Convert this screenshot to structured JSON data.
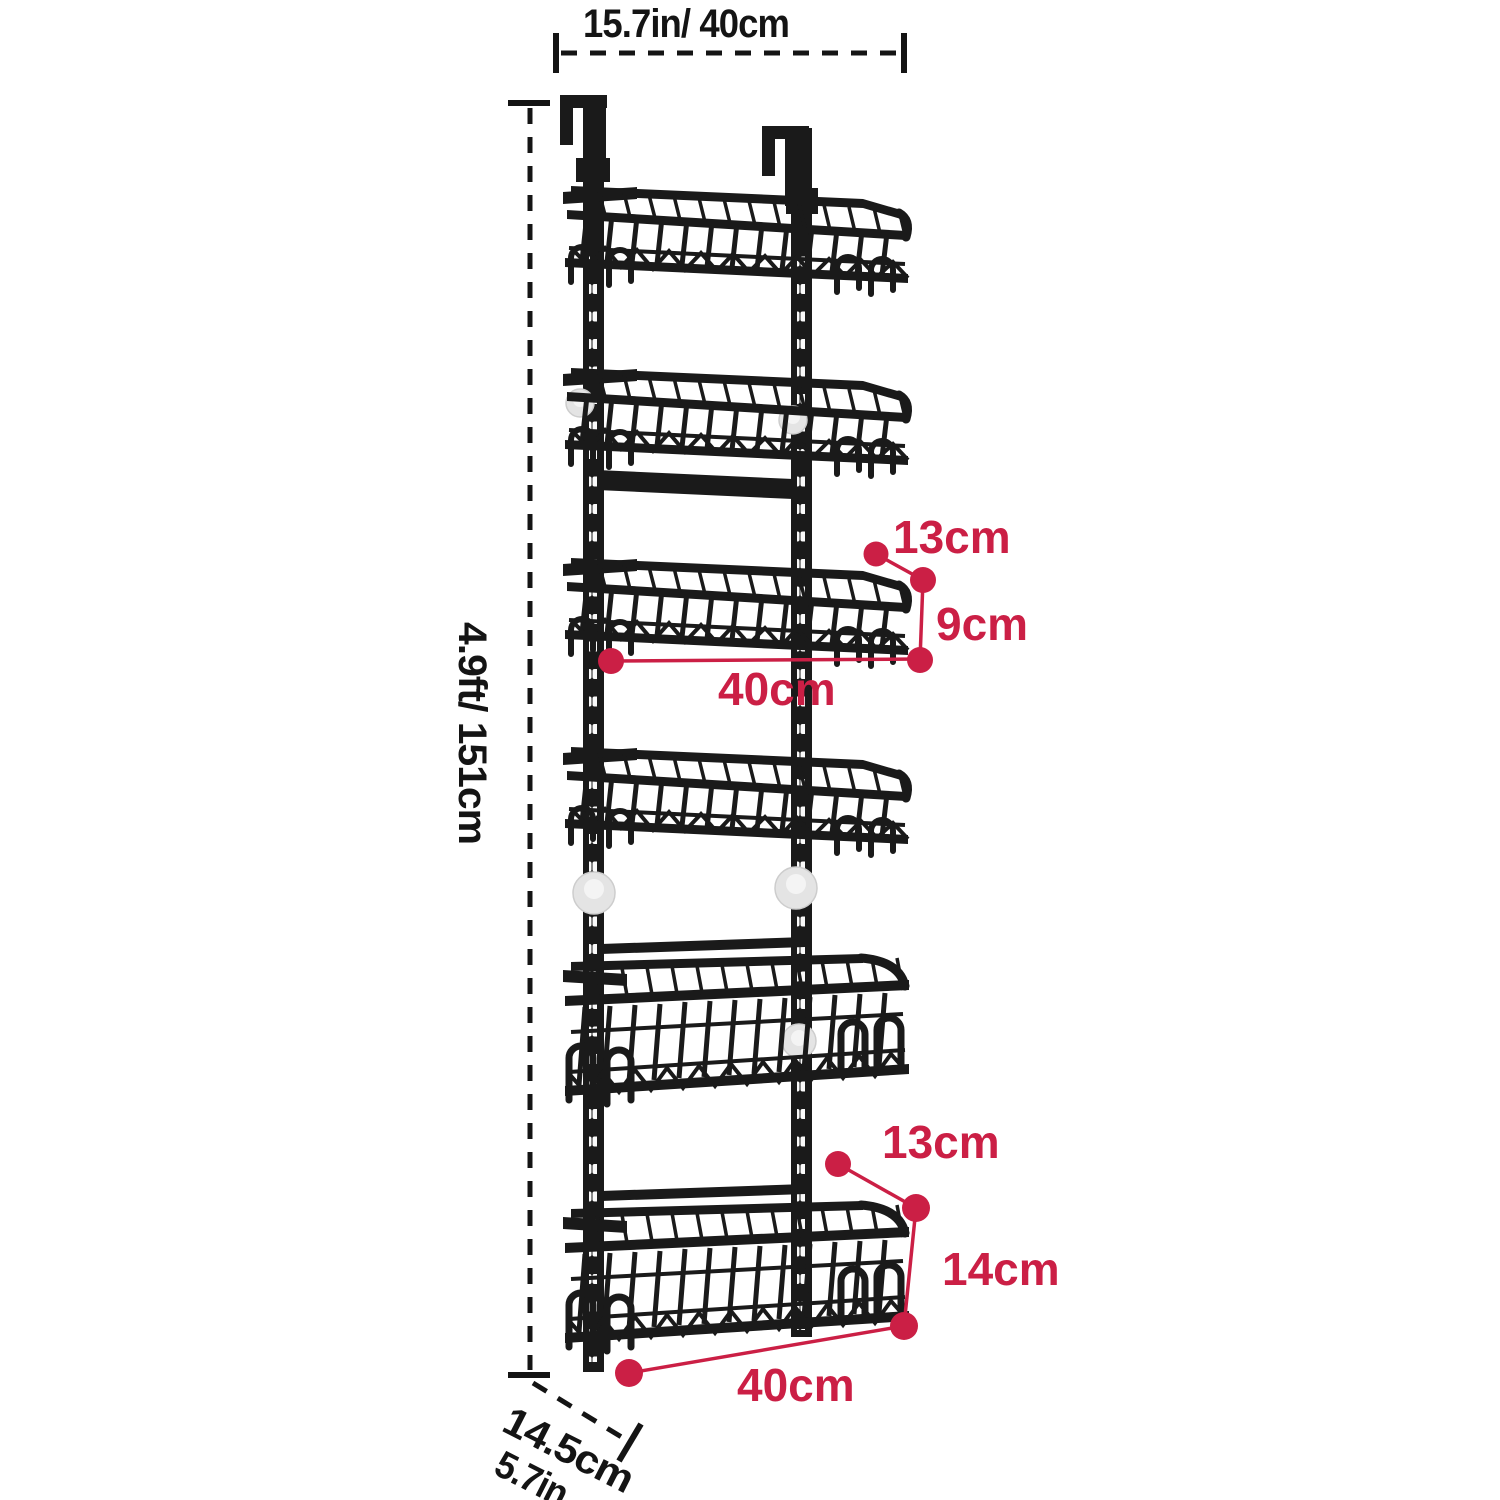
{
  "figure": {
    "type": "product-dimension-diagram",
    "subject": "over-door-hanging-basket-rack",
    "tiers": 6
  },
  "dimensions": {
    "top_width": "15.7in/ 40cm",
    "height": "4.9ft/ 151cm",
    "depth_metric": "14.5cm",
    "depth_imperial": "5.7in",
    "upper_basket": {
      "side_top": "13cm",
      "side_height": "9cm",
      "width": "40cm"
    },
    "bottom_basket": {
      "side_top": "13cm",
      "side_height": "14cm",
      "width": "40cm"
    }
  },
  "colors": {
    "annotation": "#cb1f45",
    "dimension_ink": "#141414",
    "rack": "#1a1a1a",
    "background": "#ffffff"
  }
}
